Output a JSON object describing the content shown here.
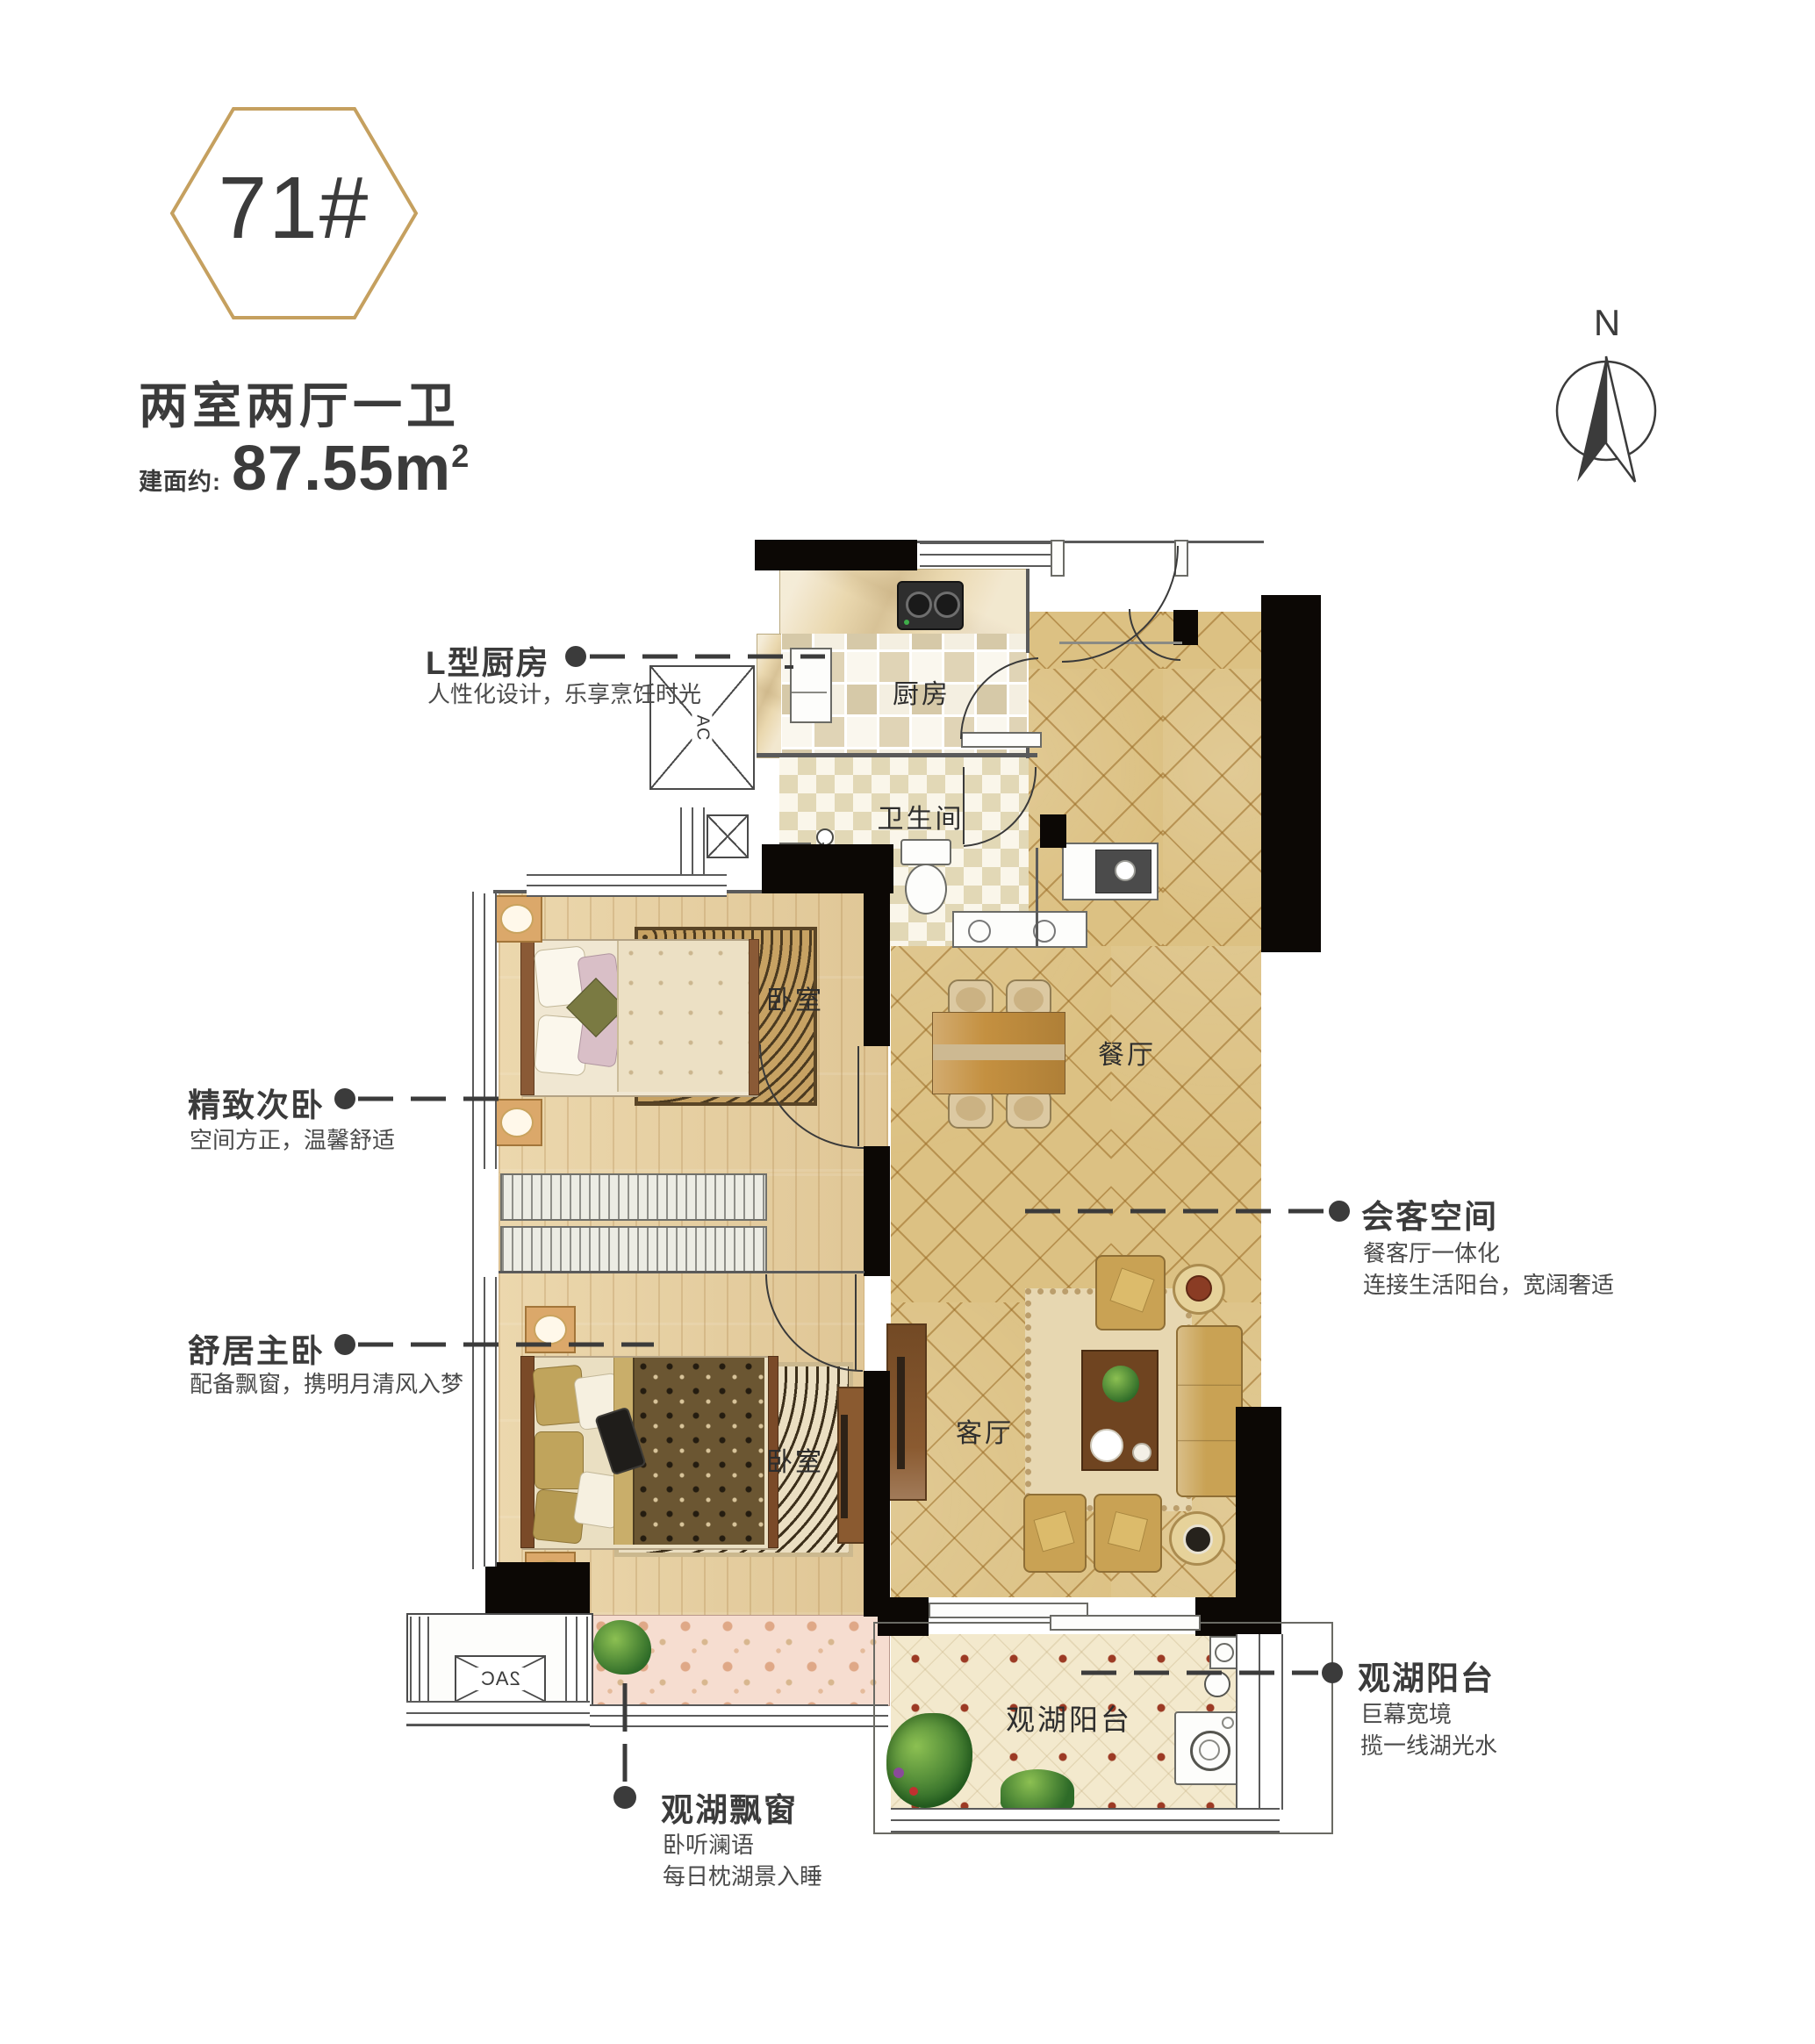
{
  "header": {
    "badge": "71#",
    "title": "两室两厅一卫",
    "area_label": "建面约:",
    "area_value": "87.55m",
    "area_sup": "2"
  },
  "compass": {
    "north": "N"
  },
  "rooms": {
    "kitchen": "厨房",
    "bathroom": "卫生间",
    "bedroom_second": "卧室",
    "bedroom_master": "卧室",
    "dining": "餐厅",
    "living": "客厅",
    "balcony": "观湖阳台"
  },
  "fixtures": {
    "ac_top": "AC",
    "ac_bottom": "2AC"
  },
  "callouts": {
    "kitchen": {
      "title": "L型厨房",
      "line1": "人性化设计，乐享烹饪时光"
    },
    "second_bedroom": {
      "title": "精致次卧",
      "line1": "空间方正，温馨舒适"
    },
    "master_bedroom": {
      "title": "舒居主卧",
      "line1": "配备飘窗，携明月清风入梦"
    },
    "guest_space": {
      "title": "会客空间",
      "line1": "餐客厅一体化",
      "line2": "连接生活阳台，宽阔奢适"
    },
    "lake_balcony": {
      "title": "观湖阳台",
      "line1": "巨幕宽境",
      "line2": "揽一线湖光水"
    },
    "bay_window": {
      "title": "观湖飘窗",
      "line1": "卧听澜语",
      "line2": "每日枕湖景入睡"
    }
  },
  "colors": {
    "accent_gold": "#c5a05f",
    "wall_black": "#0c0805",
    "text_dark": "#3b3b3b",
    "floor_gold": "#dcc183",
    "wood_floor": "#e9d2a2"
  }
}
